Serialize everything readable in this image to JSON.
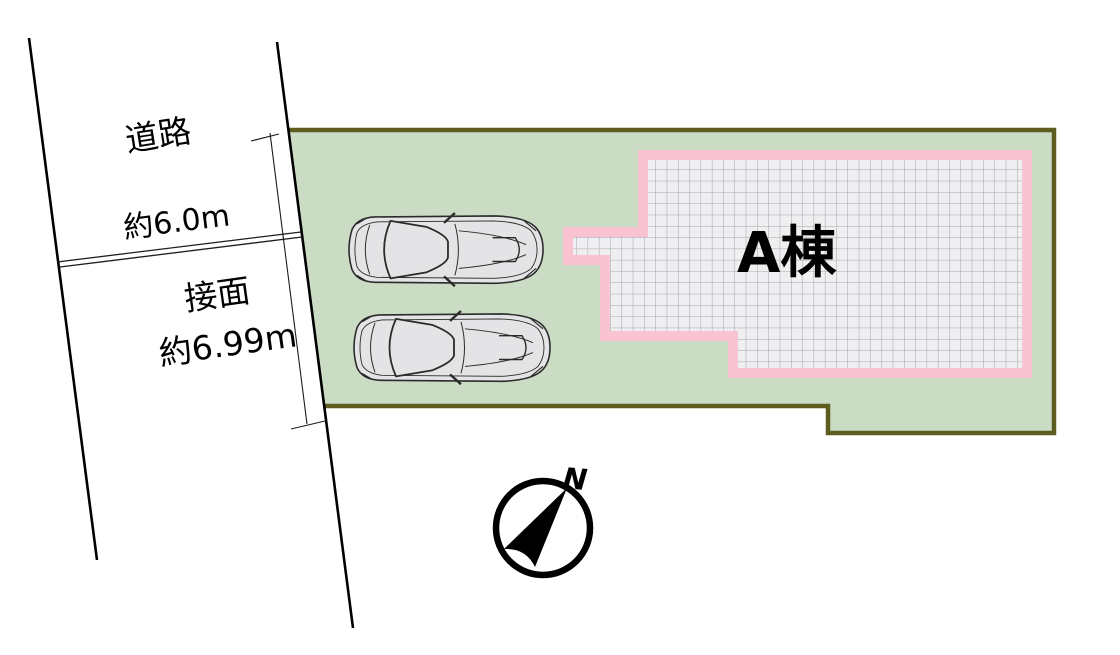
{
  "diagram": {
    "road": {
      "label": "道路",
      "width_label": "約6.0m"
    },
    "frontage": {
      "label": "接面",
      "length_label": "約6.99m"
    },
    "building": {
      "label": "A棟"
    },
    "compass": {
      "north_label": "N"
    },
    "cars_count": 2
  },
  "colors": {
    "plot_fill": "#cbdcc5",
    "plot_border": "#5d5d20",
    "building_border": "#f9c3d1",
    "building_fill": "#efeef0",
    "building_grid": "#a6a6a8",
    "car_fill": "#e4e4e6",
    "car_outline": "#2b2b2b",
    "ink": "#1c1c1c",
    "compass_ink": "#000000"
  }
}
